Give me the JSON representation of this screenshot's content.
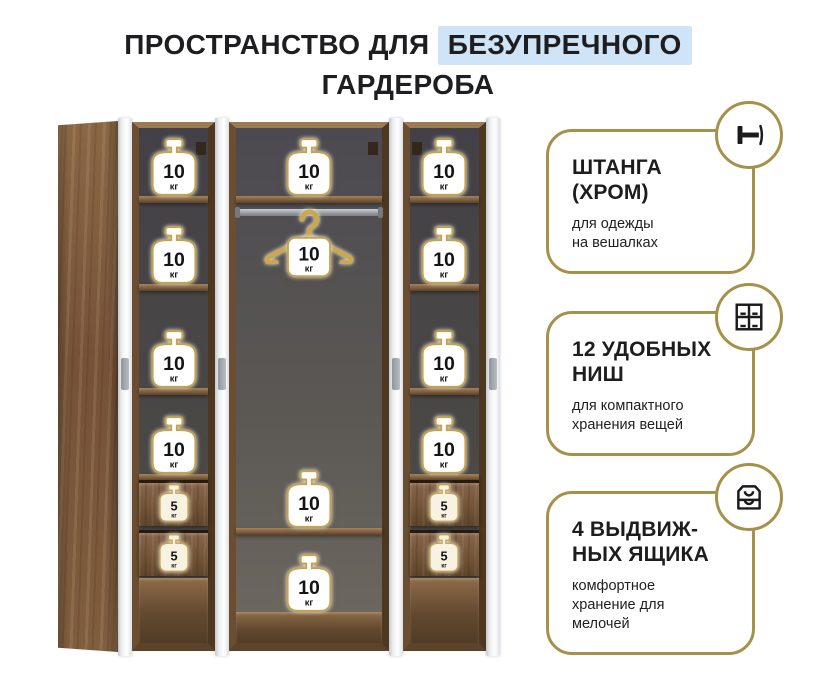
{
  "title": {
    "prefix": "ПРОСТРАНСТВО ДЛЯ",
    "highlight": "БЕЗУПРЕЧНОГО",
    "line2": "ГАРДЕРОБА"
  },
  "wardrobe": {
    "left_column": {
      "shelf_badges": [
        {
          "value": "10",
          "unit": "кг"
        },
        {
          "value": "10",
          "unit": "кг"
        },
        {
          "value": "10",
          "unit": "кг"
        },
        {
          "value": "10",
          "unit": "кг"
        }
      ],
      "drawer_badges": [
        {
          "value": "5",
          "unit": "кг"
        },
        {
          "value": "5",
          "unit": "кг"
        }
      ]
    },
    "middle_section": {
      "top_badge": {
        "value": "10",
        "unit": "кг"
      },
      "hanger_badge": {
        "value": "10",
        "unit": "кг"
      },
      "shelf_badge": {
        "value": "10",
        "unit": "кг"
      },
      "bottom_badge": {
        "value": "10",
        "unit": "кг"
      }
    },
    "right_column": {
      "shelf_badges": [
        {
          "value": "10",
          "unit": "кг"
        },
        {
          "value": "10",
          "unit": "кг"
        },
        {
          "value": "10",
          "unit": "кг"
        },
        {
          "value": "10",
          "unit": "кг"
        }
      ],
      "drawer_badges": [
        {
          "value": "5",
          "unit": "кг"
        },
        {
          "value": "5",
          "unit": "кг"
        }
      ]
    }
  },
  "features": [
    {
      "icon": "clothes-rail-icon",
      "title": "ШТАНГА\n(ХРОМ)",
      "description": "для одежды\nна вешалках"
    },
    {
      "icon": "niches-grid-icon",
      "title": "12 УДОБНЫХ\nНИШ",
      "description": "для компактного\nхранения вещей"
    },
    {
      "icon": "drawers-icon",
      "title": "4 ВЫДВИЖ-\nНЫХ ЯЩИКА",
      "description": "комфортное\nхранение для\nмелочей"
    }
  ],
  "colors": {
    "accent_gold": "#a6914b",
    "highlight_blue": "#cfe4f6",
    "badge_outline": "#c5a24c",
    "text_dark": "#1d1d1f"
  }
}
